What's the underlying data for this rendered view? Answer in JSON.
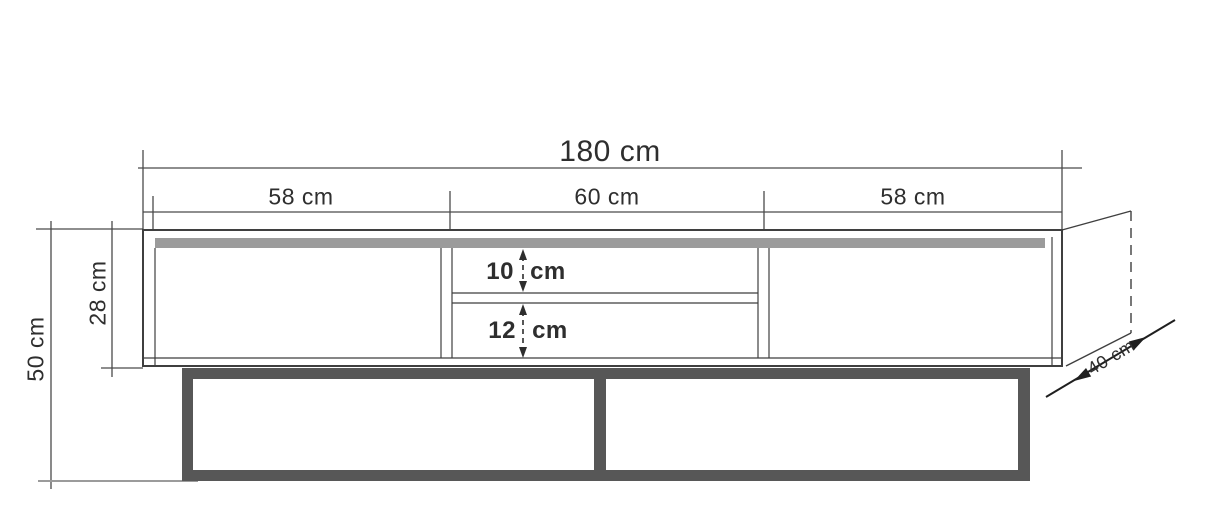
{
  "drawing": {
    "title": "TV stand technical dimension drawing",
    "view": "front elevation with depth projection",
    "labels": {
      "total_width": "180 cm",
      "left_section": "58 cm",
      "middle_section": "60 cm",
      "right_section": "58 cm",
      "total_height": "50 cm",
      "body_height": "28 cm",
      "upper_shelf_gap": "10 cm",
      "lower_shelf_gap": "12 cm",
      "depth": "40 cm"
    },
    "colors": {
      "line": "#3f3f3f",
      "dimension_line": "#4a4a4a",
      "top_panel_gray": "#9b9b9b",
      "base_frame_dark": "#575757",
      "ground_line": "#9b9b9b",
      "background": "#ffffff"
    }
  }
}
